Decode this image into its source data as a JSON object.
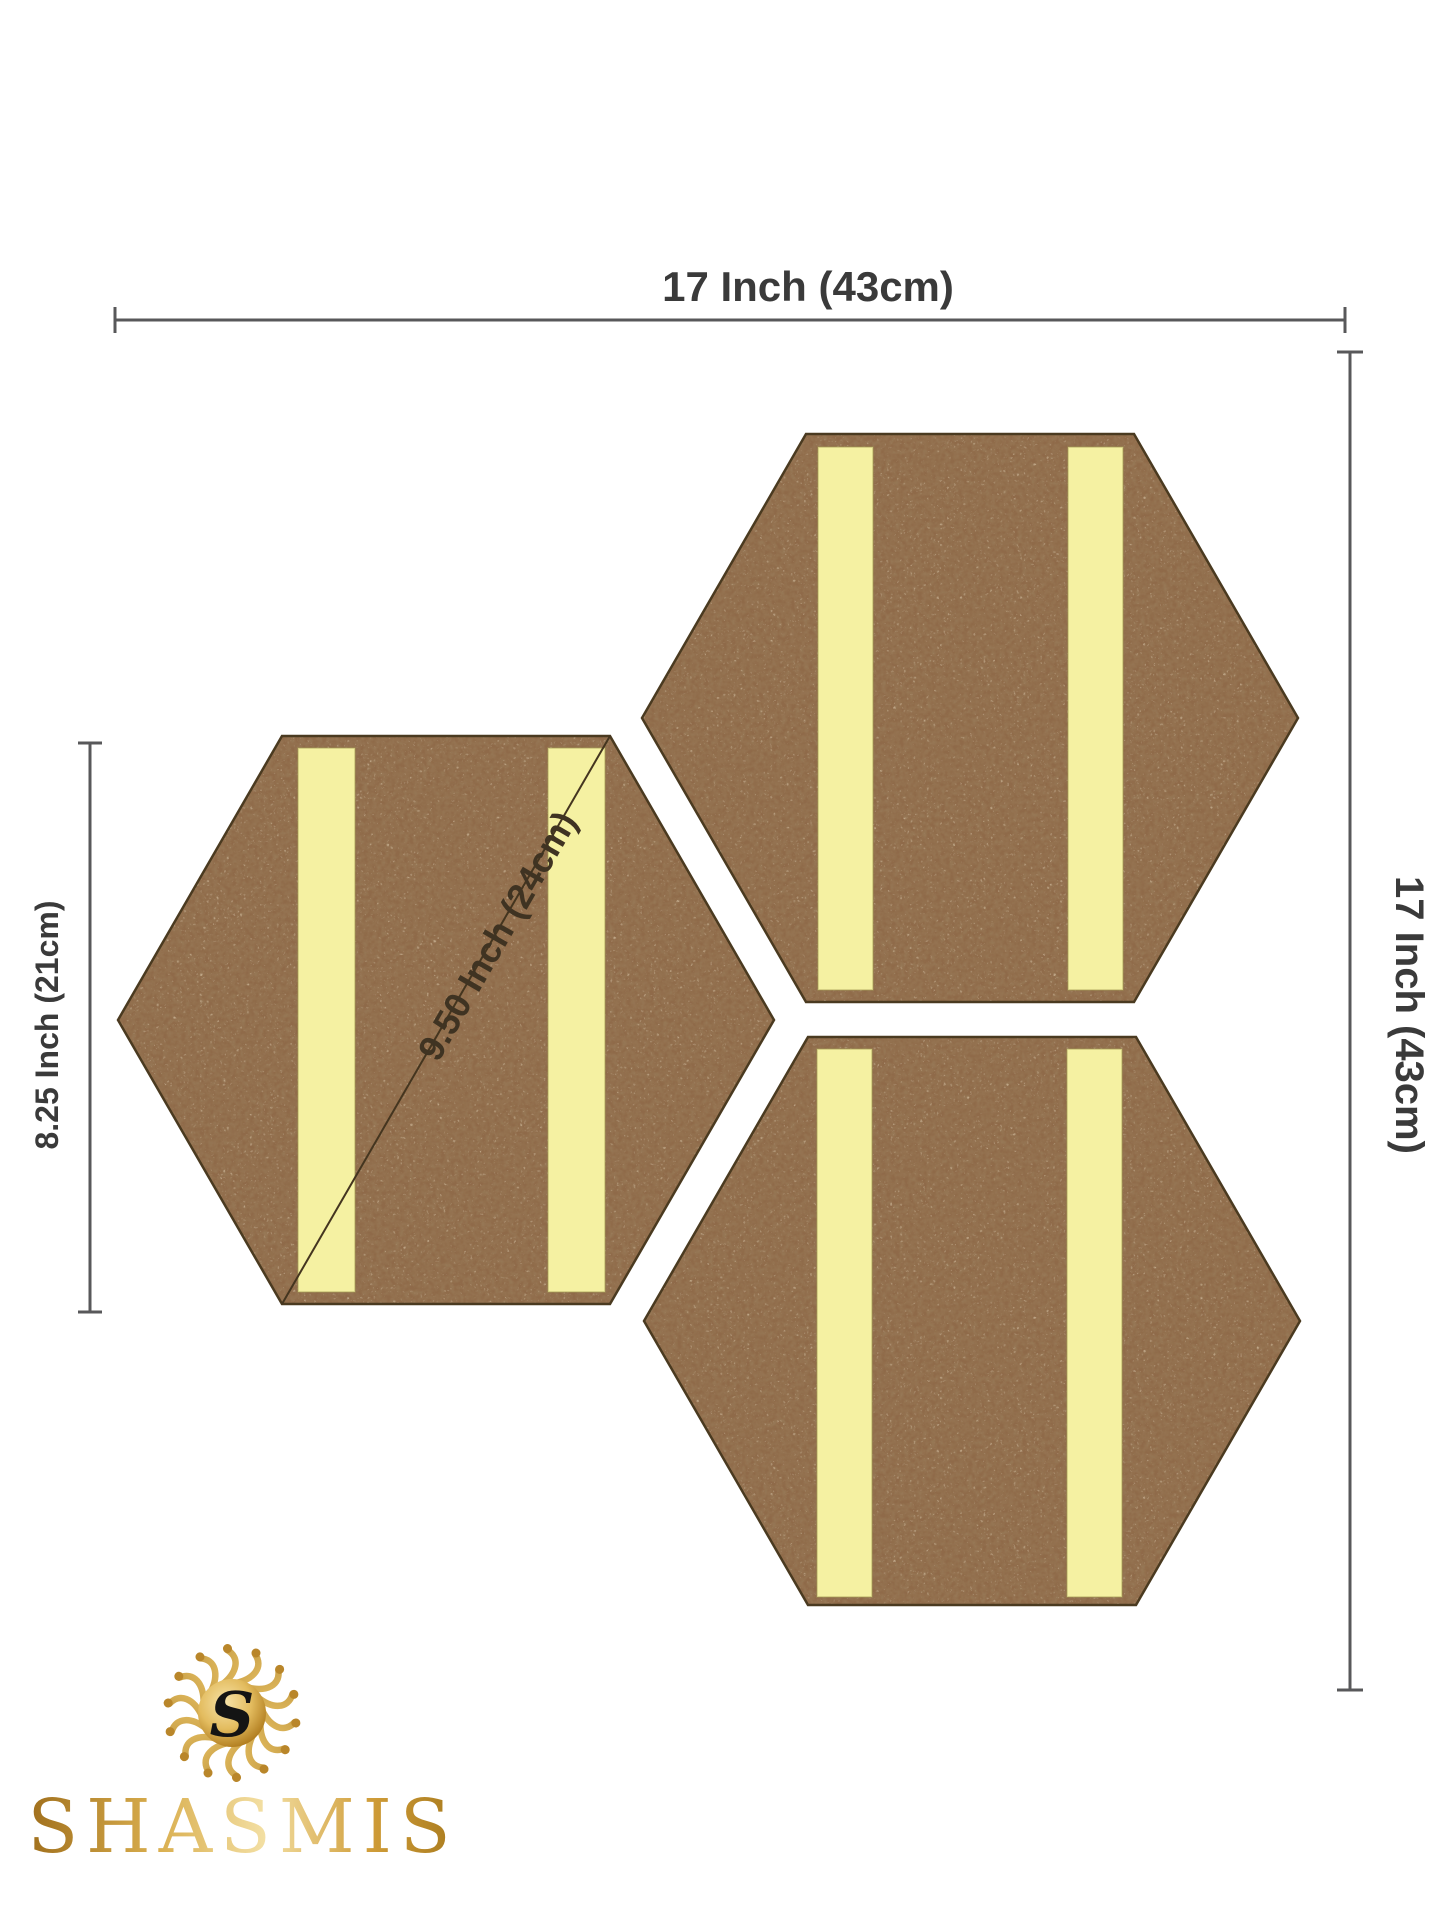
{
  "diagram": {
    "dimensions": {
      "width_top": "17 Inch (43cm)",
      "height_right": "17 Inch (43cm)",
      "tile_height_left": "8.25 Inch (21cm)",
      "tile_diagonal": "9.50 Inch (24cm)"
    },
    "tiles": {
      "count": 3,
      "strips_per_tile": 2
    }
  },
  "brand": {
    "wordmark": "SHASMIS",
    "monogram": "S"
  },
  "colors": {
    "background": "#ffffff",
    "cork_base": "#8f6a49",
    "cork_speckle_dark": "#52351c",
    "cork_speckle_light": "#b8916a",
    "strip_yellow": "#f5f1a2",
    "strip_edge": "#a39b54",
    "tile_outline": "#4a3a20",
    "dimension_line": "#58585a",
    "dimension_text": "#3a3a3a",
    "diagonal_line": "#44351f",
    "diagonal_text": "#3f3322",
    "gold_dark": "#9a6b17",
    "gold_mid": "#c8962e",
    "gold_light": "#f0d48a",
    "monogram_ink": "#141414"
  }
}
